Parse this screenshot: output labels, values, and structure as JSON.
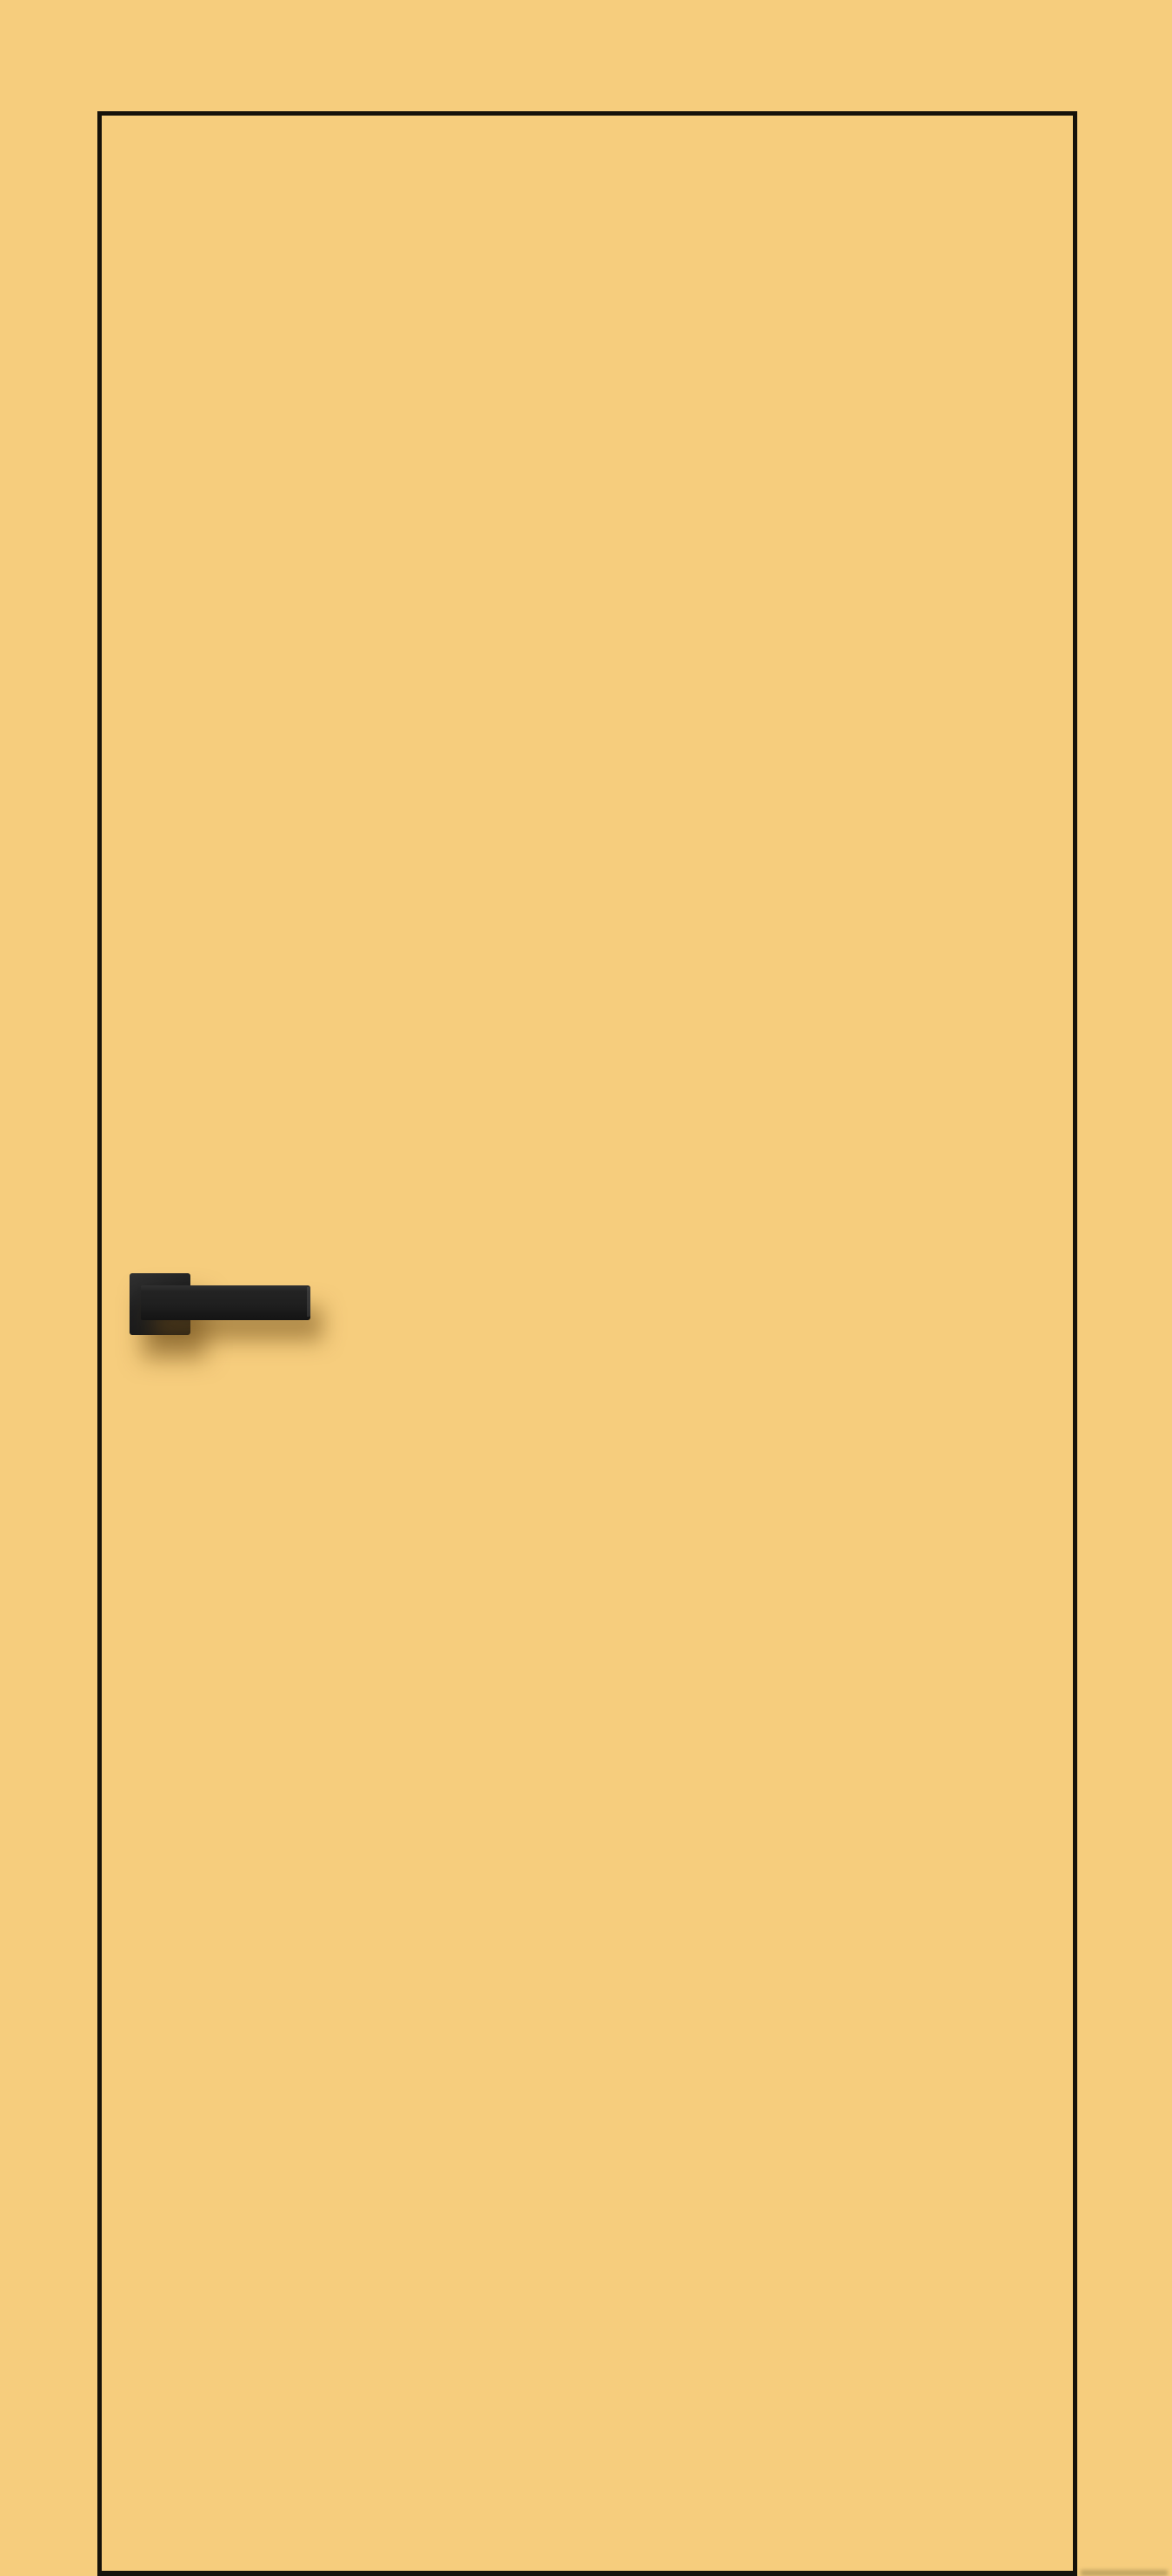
{
  "scene": {
    "description": "Product image of an interior flush door painted mustard yellow, shown against a matching mustard background, with a thin dark edge outline and a matte-black lever handle on a square rosette",
    "door": {
      "style": "flush, frameless, full-height",
      "handle": {
        "type": "lever on square rosette",
        "position": "left side, mid-height"
      }
    }
  },
  "colors": {
    "background": "#f6cd7d",
    "door_face": "#f6cd7d",
    "outline": "#16120a",
    "handle": "#1f1f1f",
    "handle_highlight": "#313131",
    "shadow": "rgba(110,76,24,0.5)"
  }
}
